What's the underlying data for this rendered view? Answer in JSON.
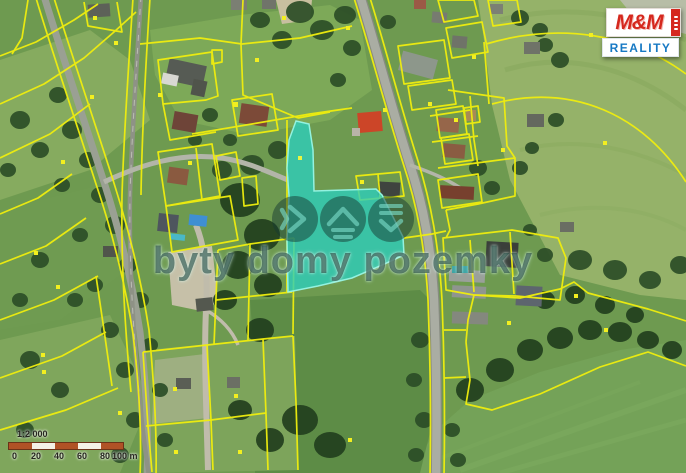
{
  "watermark": {
    "text": "byty domy pozemky"
  },
  "logo": {
    "top_text": "M&M",
    "bottom_text": "REALITY",
    "red_color": "#d5281e",
    "blue_color": "#1779c4"
  },
  "scale": {
    "ratio_label": "1:2 000",
    "tick_labels": [
      "0",
      "20",
      "40",
      "60",
      "80",
      "100 m"
    ],
    "bar_dark_color": "#b05226",
    "bar_light_color": "#f4f1e6"
  },
  "map": {
    "parcel_line_color": "#f0ee0e",
    "highlight_fill_color": "#2bcebe",
    "marker_color": "#f2ef20"
  }
}
